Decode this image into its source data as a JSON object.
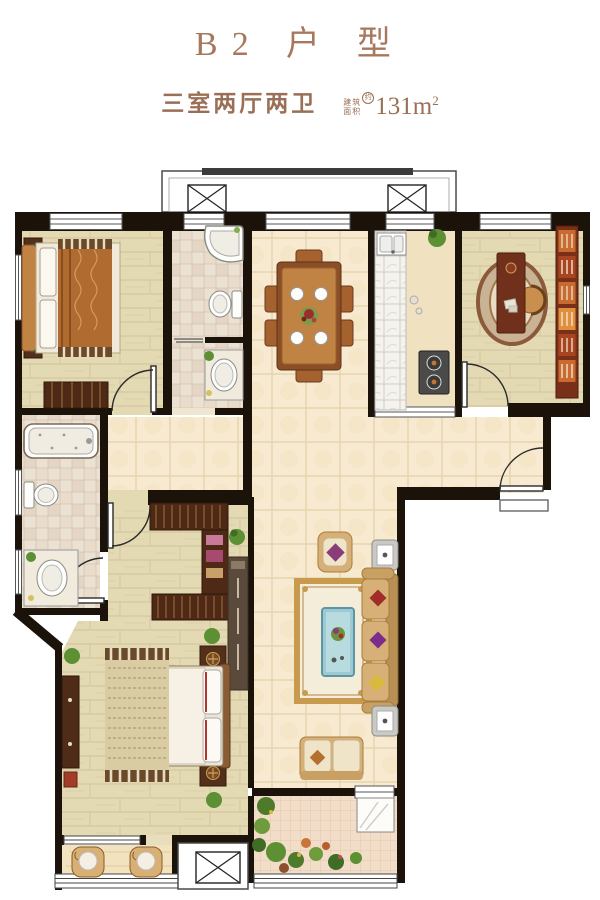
{
  "header": {
    "title": "B2 户 型",
    "subtitle": "三室两厅两卫",
    "area_label_top": "建筑",
    "area_label_bottom": "面积",
    "area_approx_mark": "约",
    "area_value": "131m",
    "area_unit_sup": "2"
  },
  "palette": {
    "title_text": "#a6795e",
    "subtitle_text": "#9a6f55",
    "wall": "#1b130a",
    "tile_floor": "#f7ead0",
    "wood_floor": "#e3d9b3",
    "bath_floor": "#ece2d4",
    "kitchen_counter": "#f4f3ee",
    "balcony_floor": "#f3e2be",
    "garden_floor": "#f2ddc8",
    "furniture_wood": "#b97a3e",
    "furniture_dark": "#54301b",
    "sofa_tan": "#d7b077",
    "coffee_table_teal": "#9ec9d2",
    "plant_green": "#5d8f33",
    "bookshelf_orange": "#c96a2e"
  }
}
